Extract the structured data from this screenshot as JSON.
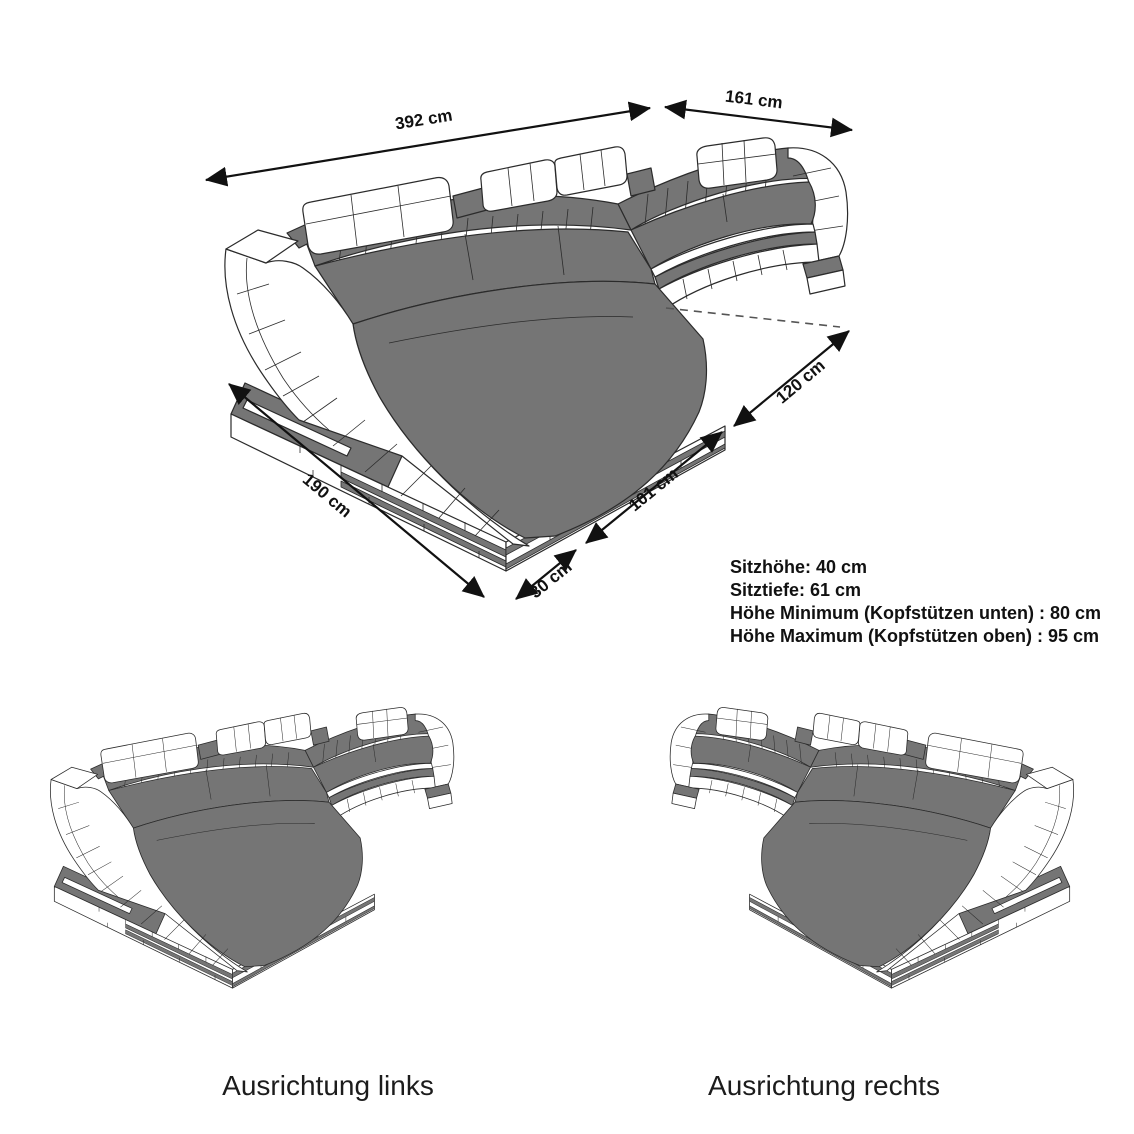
{
  "main_diagram": {
    "dimension_labels": {
      "back_width": "392 cm",
      "right_back_width": "161 cm",
      "right_depth": "120 cm",
      "front_right": "101 cm",
      "front_corner": "30 cm",
      "chaise_side": "190 cm"
    },
    "specs": {
      "line1": "Sitzhöhe: 40 cm",
      "line2": "Sitztiefe: 61 cm",
      "line3": "Höhe Minimum (Kopfstützen unten) : 80 cm",
      "line4": "Höhe Maximum (Kopfstützen oben) : 95 cm"
    }
  },
  "variants": {
    "left": {
      "label": "Ausrichtung links"
    },
    "right": {
      "label": "Ausrichtung rechts"
    }
  },
  "colors": {
    "upholstery_gray": "#757575",
    "outline": "#2b2b2b",
    "background": "#ffffff"
  }
}
